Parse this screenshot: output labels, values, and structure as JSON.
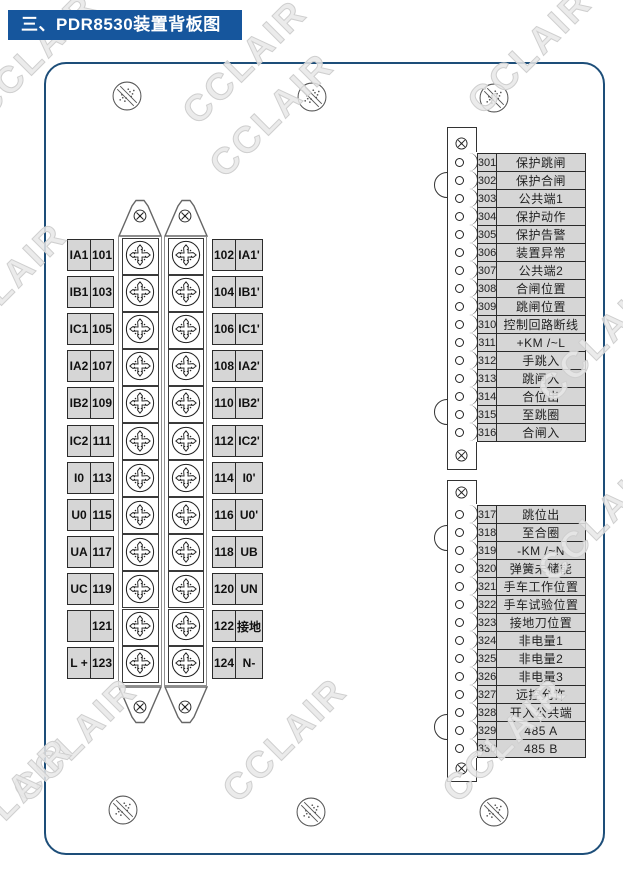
{
  "title": "三、PDR8530装置背板图",
  "watermark": "CCLAIR",
  "colors": {
    "title_bg": "#16569d",
    "panel_border": "#1d4e79",
    "cell_bg": "#d6d6d6",
    "line": "#333333"
  },
  "icons": {
    "mount_screw": "slashed-knurled-screw",
    "terminal_screw": "phillips-star-screw",
    "small_screw": "cross-head-screw"
  },
  "left_block": {
    "rows": [
      {
        "left_label": "IA1",
        "left_no": "101",
        "right_no": "102",
        "right_label": "IA1'"
      },
      {
        "left_label": "IB1",
        "left_no": "103",
        "right_no": "104",
        "right_label": "IB1'"
      },
      {
        "left_label": "IC1",
        "left_no": "105",
        "right_no": "106",
        "right_label": "IC1'"
      },
      {
        "left_label": "IA2",
        "left_no": "107",
        "right_no": "108",
        "right_label": "IA2'"
      },
      {
        "left_label": "IB2",
        "left_no": "109",
        "right_no": "110",
        "right_label": "IB2'"
      },
      {
        "left_label": "IC2",
        "left_no": "111",
        "right_no": "112",
        "right_label": "IC2'"
      },
      {
        "left_label": "I0",
        "left_no": "113",
        "right_no": "114",
        "right_label": "I0'"
      },
      {
        "left_label": "U0",
        "left_no": "115",
        "right_no": "116",
        "right_label": "U0'"
      },
      {
        "left_label": "UA",
        "left_no": "117",
        "right_no": "118",
        "right_label": "UB"
      },
      {
        "left_label": "UC",
        "left_no": "119",
        "right_no": "120",
        "right_label": "UN"
      },
      {
        "left_label": "",
        "left_no": "121",
        "right_no": "122",
        "right_label": "接地"
      },
      {
        "left_label": "L +",
        "left_no": "123",
        "right_no": "124",
        "right_label": "N-"
      }
    ]
  },
  "strip1": {
    "rows": [
      {
        "no": "301",
        "label": "保护跳闸"
      },
      {
        "no": "302",
        "label": "保护合闸"
      },
      {
        "no": "303",
        "label": "公共端1"
      },
      {
        "no": "304",
        "label": "保护动作"
      },
      {
        "no": "305",
        "label": "保护告警"
      },
      {
        "no": "306",
        "label": "装置异常"
      },
      {
        "no": "307",
        "label": "公共端2"
      },
      {
        "no": "308",
        "label": "合闸位置"
      },
      {
        "no": "309",
        "label": "跳闸位置"
      },
      {
        "no": "310",
        "label": "控制回路断线"
      },
      {
        "no": "311",
        "label": "+KM /~L"
      },
      {
        "no": "312",
        "label": "手跳入"
      },
      {
        "no": "313",
        "label": "跳闸入"
      },
      {
        "no": "314",
        "label": "合位出"
      },
      {
        "no": "315",
        "label": "至跳圈"
      },
      {
        "no": "316",
        "label": "合闸入"
      }
    ]
  },
  "strip2": {
    "rows": [
      {
        "no": "317",
        "label": "跳位出"
      },
      {
        "no": "318",
        "label": "至合圈"
      },
      {
        "no": "319",
        "label": "-KM /~N"
      },
      {
        "no": "320",
        "label": "弹簧未储能"
      },
      {
        "no": "321",
        "label": "手车工作位置"
      },
      {
        "no": "322",
        "label": "手车试验位置"
      },
      {
        "no": "323",
        "label": "接地刀位置"
      },
      {
        "no": "324",
        "label": "非电量1"
      },
      {
        "no": "325",
        "label": "非电量2"
      },
      {
        "no": "326",
        "label": "非电量3"
      },
      {
        "no": "327",
        "label": "远控允许"
      },
      {
        "no": "328",
        "label": "开入公共端"
      },
      {
        "no": "329",
        "label": "485 A"
      },
      {
        "no": "330",
        "label": "485 B"
      }
    ]
  }
}
